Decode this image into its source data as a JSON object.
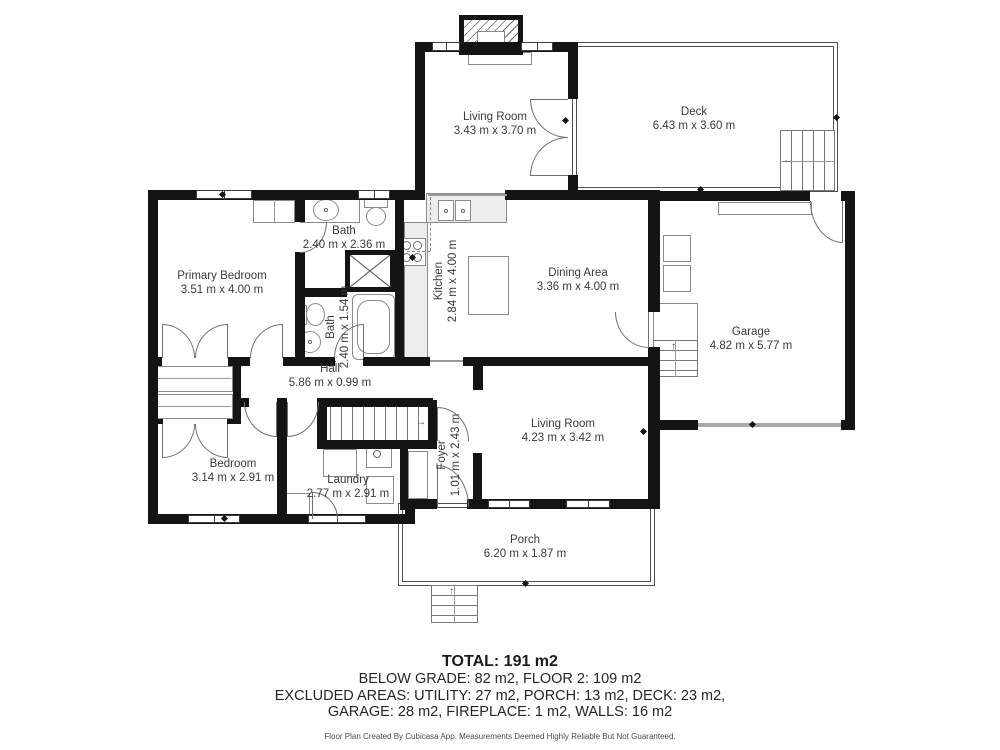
{
  "plan": {
    "rooms": {
      "living_room_upper": {
        "name": "Living Room",
        "dims": "3.43 m x 3.70 m"
      },
      "deck": {
        "name": "Deck",
        "dims": "6.43 m x 3.60 m"
      },
      "primary_bedroom": {
        "name": "Primary Bedroom",
        "dims": "3.51 m x 4.00 m"
      },
      "bath_upper": {
        "name": "Bath",
        "dims": "2.40 m x 2.36 m"
      },
      "bath_lower": {
        "name": "Bath",
        "dims": "2.40 m x 1.54 m"
      },
      "kitchen": {
        "name": "Kitchen",
        "dims": "2.84 m x 4.00 m"
      },
      "dining_area": {
        "name": "Dining Area",
        "dims": "3.36 m x 4.00 m"
      },
      "garage": {
        "name": "Garage",
        "dims": "4.82 m x 5.77 m"
      },
      "hall": {
        "name": "Hall",
        "dims": "5.86 m x 0.99 m"
      },
      "bedroom": {
        "name": "Bedroom",
        "dims": "3.14 m x 2.91 m"
      },
      "laundry": {
        "name": "Laundry",
        "dims": "2.77 m x 2.91 m"
      },
      "foyer": {
        "name": "Foyer",
        "dims": "1.01 m x 2.43 m"
      },
      "living_room_lower": {
        "name": "Living Room",
        "dims": "4.23 m x 3.42 m"
      },
      "porch": {
        "name": "Porch",
        "dims": "6.20 m x 1.87 m"
      }
    },
    "summary": {
      "total": "TOTAL: 191 m2",
      "grade_line": "BELOW GRADE: 82 m2, FLOOR 2: 109 m2",
      "excluded_line1": "EXCLUDED AREAS: UTILITY: 27 m2, PORCH: 13 m2, DECK: 23 m2,",
      "excluded_line2": "GARAGE: 28 m2, FIREPLACE: 1 m2, WALLS: 16 m2"
    },
    "disclaimer": "Floor Plan Created By Cubicasa App. Measurements Deemed Highly Reliable But Not Guaranteed.",
    "icons": {
      "arrow_up": "↑",
      "arrow_left": "←",
      "arrow_right": "→"
    }
  }
}
